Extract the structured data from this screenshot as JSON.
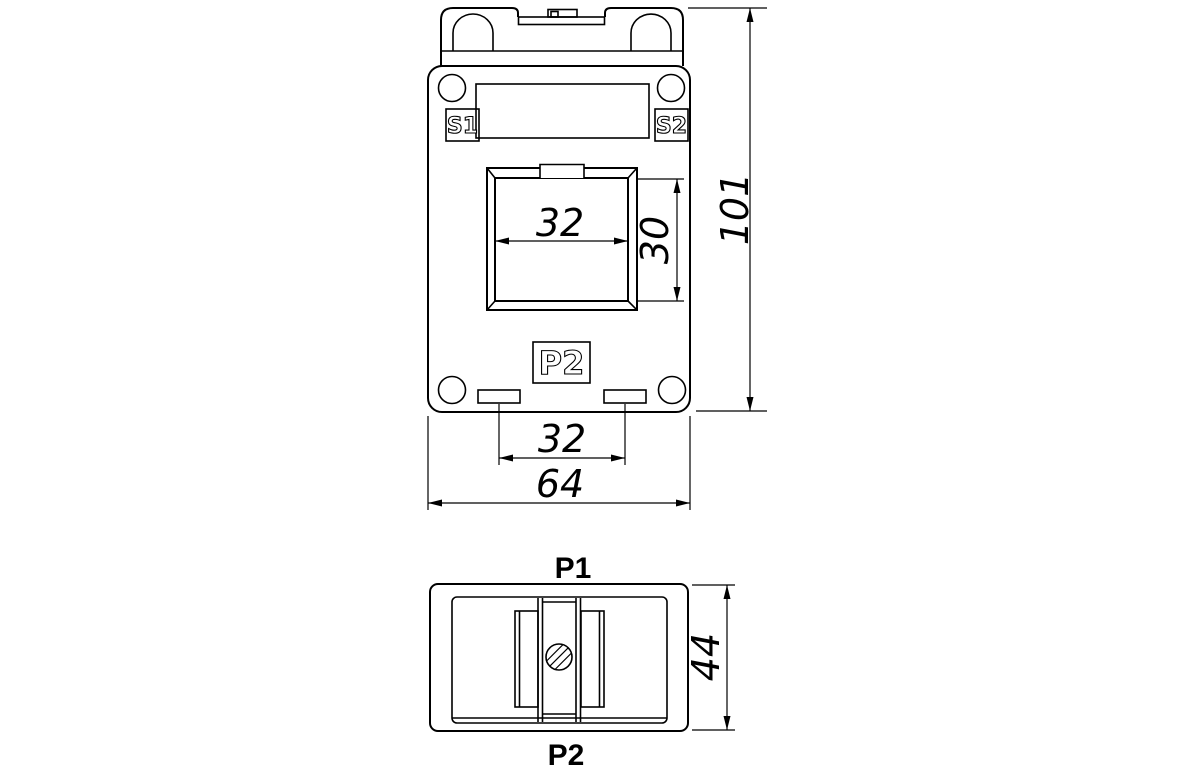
{
  "colors": {
    "line": "#000000",
    "background": "#ffffff"
  },
  "front_view": {
    "terminal_s1": "S1",
    "terminal_s2": "S2",
    "terminal_p2": "P2",
    "dims": {
      "window_width": "32",
      "window_height": "30",
      "overall_height": "101",
      "slot_spacing": "32",
      "overall_width": "64"
    }
  },
  "side_view": {
    "terminal_p1": "P1",
    "terminal_p2": "P2",
    "dims": {
      "depth": "44"
    }
  }
}
